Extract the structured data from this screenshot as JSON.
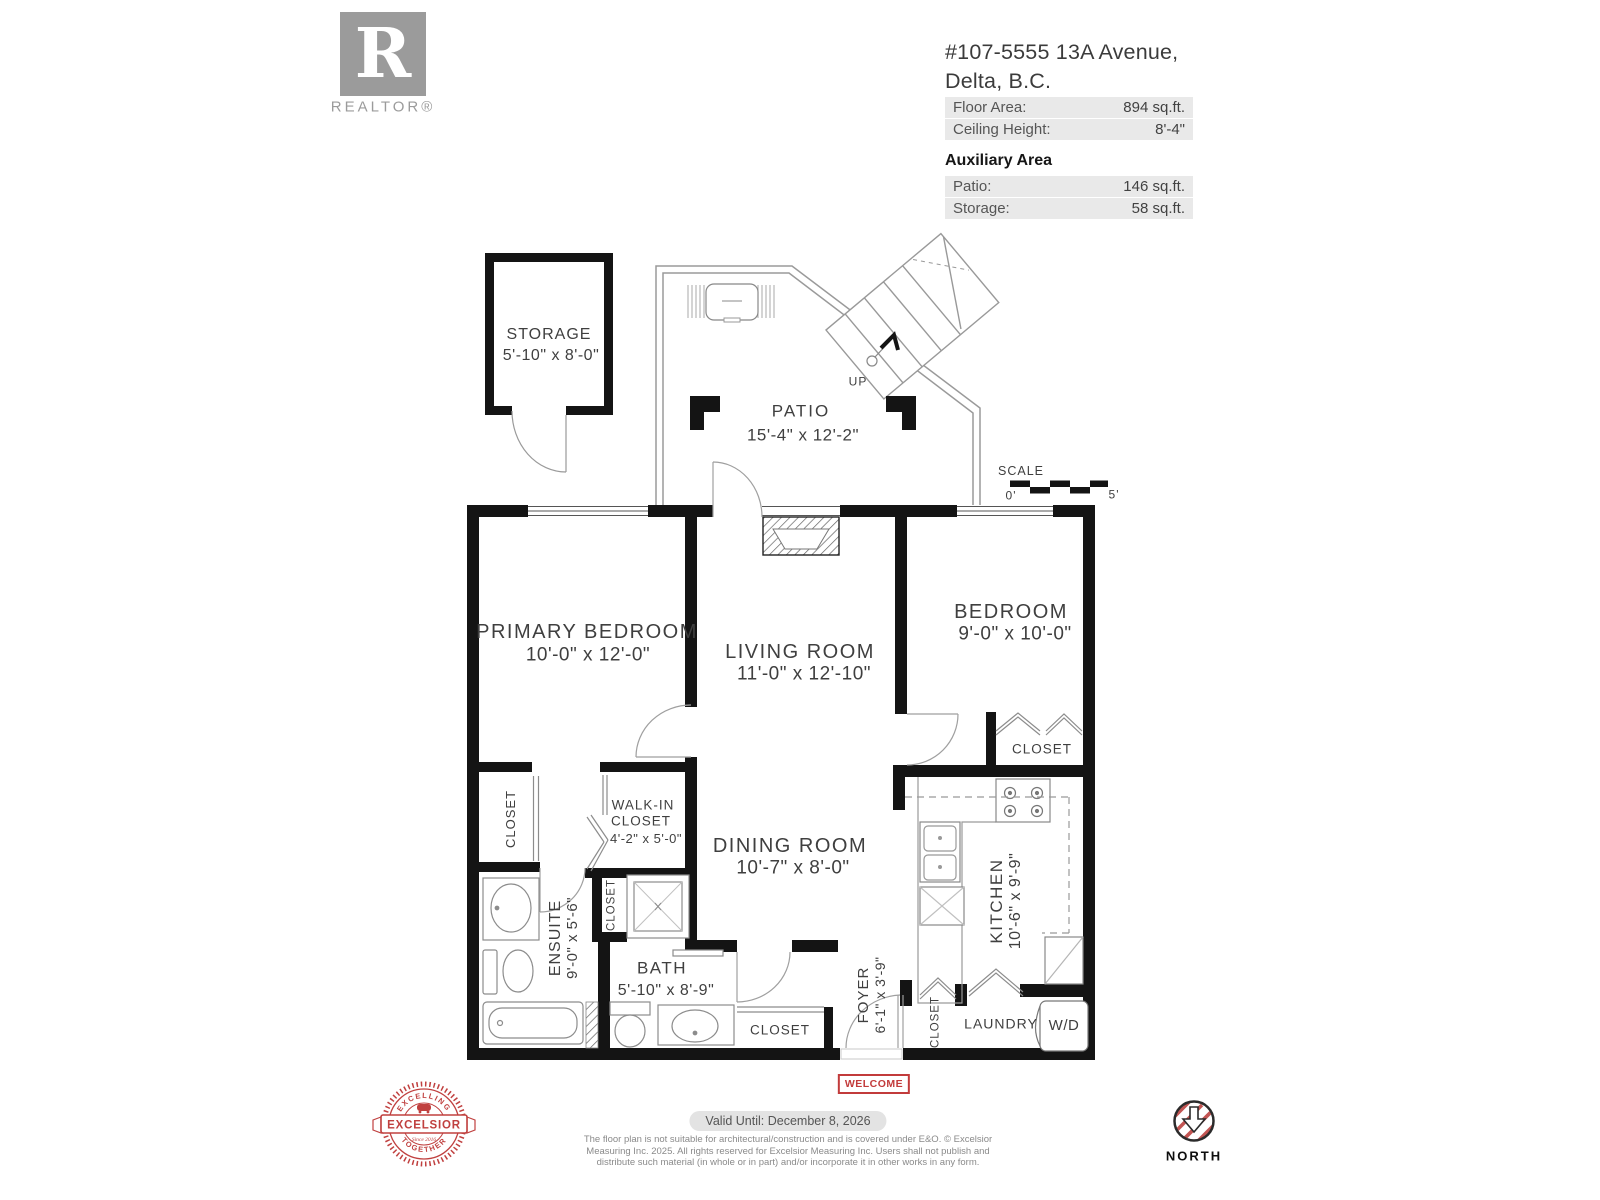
{
  "header": {
    "realtor_logo_letter": "R",
    "realtor_word": "REALTOR®",
    "address_line1": "#107-5555 13A Avenue,",
    "address_line2": "Delta, B.C.",
    "floor_area_label": "Floor Area:",
    "floor_area_value": "894 sq.ft.",
    "ceiling_label": "Ceiling Height:",
    "ceiling_value": "8'-4\"",
    "auxiliary_title": "Auxiliary Area",
    "patio_label": "Patio:",
    "patio_value": "146 sq.ft.",
    "storage_label": "Storage:",
    "storage_value": "58 sq.ft."
  },
  "rooms": {
    "storage": {
      "name": "STORAGE",
      "dims": "5'-10\" x 8'-0\""
    },
    "patio": {
      "name": "PATIO",
      "dims": "15'-4\" x 12'-2\""
    },
    "primary": {
      "name": "PRIMARY BEDROOM",
      "dims": "10'-0\" x 12'-0\""
    },
    "living": {
      "name": "LIVING ROOM",
      "dims": "11'-0\" x 12'-10\""
    },
    "bedroom": {
      "name": "BEDROOM",
      "dims": "9'-0\" x 10'-0\""
    },
    "dining": {
      "name": "DINING ROOM",
      "dims": "10'-7\" x 8'-0\""
    },
    "kitchen": {
      "name": "KITCHEN",
      "dims": "10'-6\" x 9'-9\""
    },
    "ensuite": {
      "name": "ENSUITE",
      "dims": "9'-0\" x 5'-6\""
    },
    "bath": {
      "name": "BATH",
      "dims": "5'-10\" x  8'-9\""
    },
    "walkin": {
      "line1": "WALK-IN",
      "line2": "CLOSET",
      "dims": "4'-2\" x 5'-0\""
    },
    "foyer": {
      "name": "FOYER",
      "dims": "6'-1\" x 3'-9\""
    },
    "laundry": {
      "name": "LAUNDRY",
      "wd": "W/D"
    }
  },
  "labels": {
    "closet": "CLOSET"
  },
  "annotations": {
    "up": "UP",
    "scale_label": "SCALE",
    "scale_zero": "0'",
    "scale_five": "5'",
    "welcome": "WELCOME"
  },
  "footer": {
    "badge_top": "EXCELLING",
    "badge_center": "EXCELSIOR",
    "badge_bottom": "TOGETHER",
    "badge_since": "Since 2016",
    "valid_until": "Valid Until: December 8, 2026",
    "disclaimer_line1": "The floor plan is not suitable for architectural/construction and is covered under E&O. © Excelsior",
    "disclaimer_line2": "Measuring Inc. 2025. All rights reserved for Excelsior Measuring Inc. Users shall not publish and",
    "disclaimer_line3": "distribute such material (in whole or in part) and/or incorporate it in other works in any form.",
    "north": "NORTH"
  },
  "colors": {
    "wall": "#141414",
    "accent_red": "#c0403f",
    "row_background": "#e9e9e9",
    "logo_gray": "#9b9b9b"
  }
}
